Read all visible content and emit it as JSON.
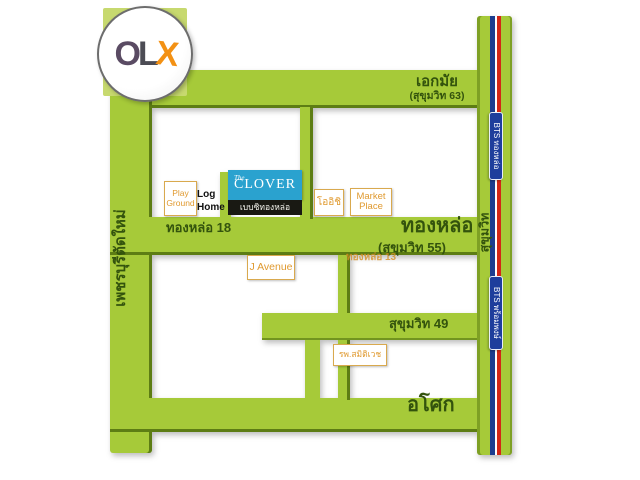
{
  "logo": {
    "o": "O",
    "l": "L",
    "x": "X"
  },
  "map": {
    "roads": {
      "ekkamai": {
        "name": "เอกมัย",
        "sub": "(สุขุมวิท 63)"
      },
      "thonglor": {
        "name": "ทองหล่อ",
        "sub": "(สุขุมวิท 55)"
      },
      "thonglor18": "ทองหล่อ 18",
      "thonglor13": "ทองหล่อ 13",
      "sukhumvit49": "สุขุมวิท 49",
      "asok": "อโศก",
      "phetchaburi": "เพชรบุรีตัดใหม่",
      "sukhumvit": "สุขุมวิท"
    },
    "places": {
      "play_ground": {
        "line1": "Play",
        "line2": "Ground"
      },
      "log_home": {
        "line1": "Log",
        "line2": "Home"
      },
      "clover": {
        "prefix": "The",
        "name": "CLOVER",
        "thai": "เบบซิทองหล่อ"
      },
      "oishi": "โออิชิ",
      "market_place": {
        "line1": "Market",
        "line2": "Place"
      },
      "j_avenue": "J Avenue",
      "samitivej": "รพ.สมิติเวช"
    },
    "bts": {
      "thonglor": "BTS ทองหล่อ",
      "phrompong": "BTS พร้อมพงษ์"
    }
  },
  "colors": {
    "road_green": "#a6ca39",
    "road_edge_green": "#5d7d14",
    "text_green": "#33530d",
    "label_orange": "#e09a30",
    "box_border": "#d9a94e",
    "clover_blue": "#2aa2cf",
    "clover_bar": "#191913",
    "bts_sign_blue": "#1e3e9c",
    "stripe_blue": "#1d3d8f",
    "stripe_red": "#d42616",
    "olx_square_green": "#c7d96f",
    "olx_x_orange": "#f39114"
  }
}
